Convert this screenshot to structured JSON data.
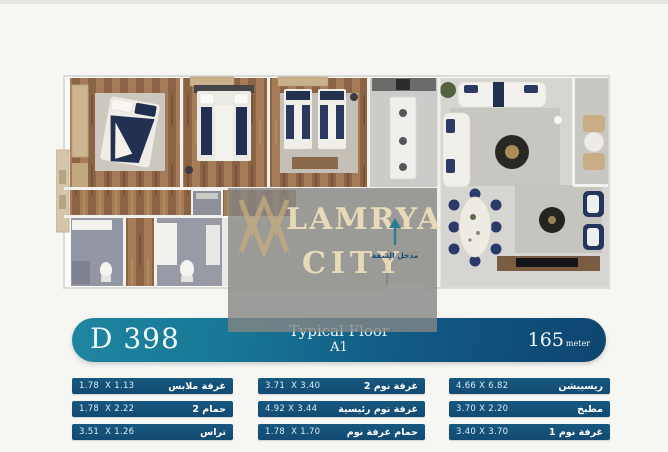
{
  "watermark": {
    "line1": "LAMRYA",
    "line2": "CITY"
  },
  "plan": {
    "entrance_label": "مدخل الشقة"
  },
  "banner": {
    "unit_code": "D 398",
    "floor_label": "Typical Floor",
    "floor_sub": "A1",
    "area_value": "165",
    "area_unit": "meter"
  },
  "colors": {
    "banner_left": "#1f85a1",
    "banner_right": "#0e456f",
    "row_blue": "#14527a",
    "watermark_gold": "#c6ac7e",
    "arrow_teal": "#2e7d8f"
  },
  "dims_table": {
    "columns": [
      {
        "rows": [
          {
            "dims": "1.78  X 1.13",
            "label": "غرفة ملابس"
          },
          {
            "dims": "1.78  X 2.22",
            "label": "حمام 2"
          },
          {
            "dims": "3.51  X 1.26",
            "label": "تراس"
          }
        ]
      },
      {
        "rows": [
          {
            "dims": "3.71  X 3.40",
            "label": "غرفة نوم 2"
          },
          {
            "dims": "4.92 X 3.44",
            "label": "غرفة نوم رئيسية"
          },
          {
            "dims": "1.78  X 1.70",
            "label": "حمام غرفة نوم"
          }
        ]
      },
      {
        "rows": [
          {
            "dims": "4.66 X 6.82",
            "label": "ريسيبشن"
          },
          {
            "dims": "3.70 X 2.20",
            "label": "مطبخ"
          },
          {
            "dims": "3.40 X 3.70",
            "label": "غرفة نوم 1"
          }
        ]
      }
    ]
  }
}
